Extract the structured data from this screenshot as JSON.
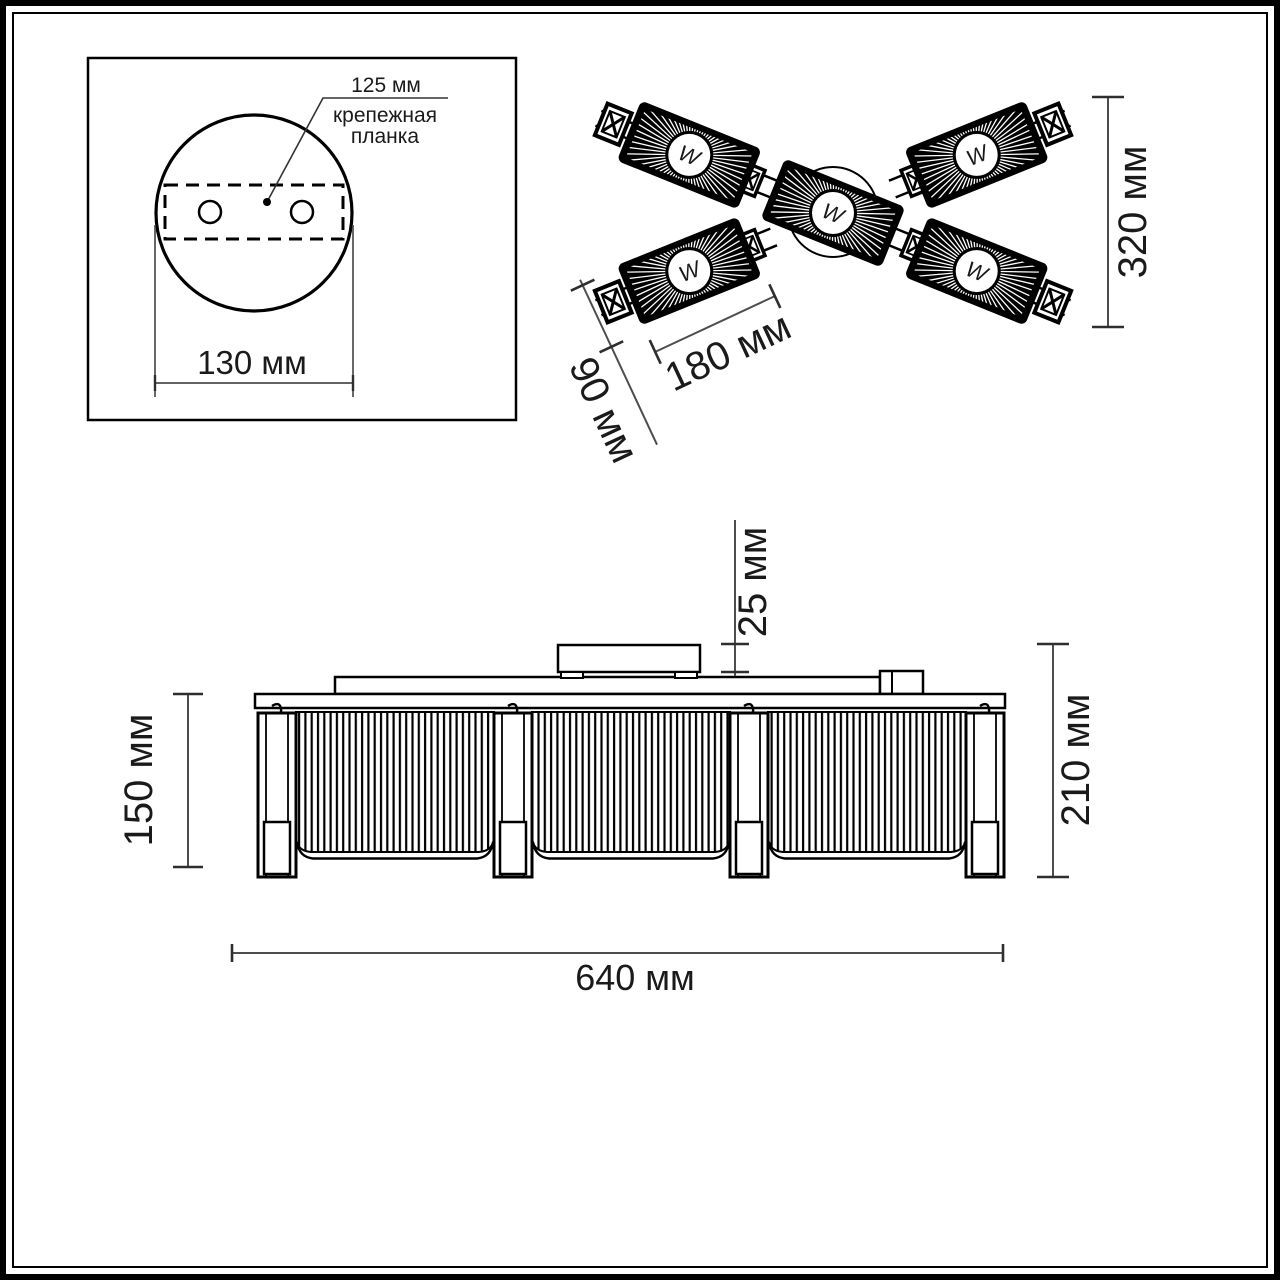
{
  "drawing": {
    "type": "lighting-fixture-dimension-drawing",
    "mounting": {
      "dim125": "125 мм",
      "label1": "крепежная",
      "label2": "планка",
      "dim130": "130 мм"
    },
    "top": {
      "symbol": "W",
      "dim320": "320 мм",
      "dim180": "180 мм",
      "dim90": "90 мм"
    },
    "side": {
      "dim25": "25 мм",
      "dim150": "150 мм",
      "dim210": "210 мм",
      "dim640": "640 мм"
    },
    "colors": {
      "ink": "#000000",
      "dim_line": "#4d4d4d",
      "tick": "#2e2e2e",
      "text": "#1a1a1a",
      "background": "#ffffff"
    }
  }
}
